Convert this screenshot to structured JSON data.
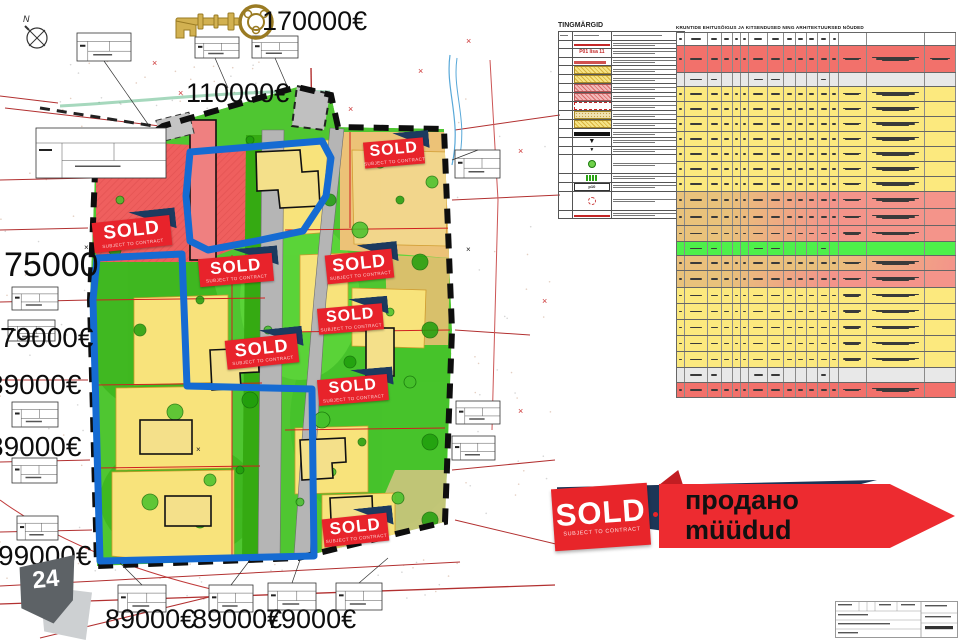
{
  "prices": [
    {
      "text": "170000€",
      "x": 262,
      "y": 6,
      "size": 27
    },
    {
      "text": "110000€",
      "x": 186,
      "y": 78,
      "size": 27
    },
    {
      "text": "75000",
      "x": 4,
      "y": 246,
      "size": 34
    },
    {
      "text": "79000€",
      "x": 0,
      "y": 322,
      "size": 28
    },
    {
      "text": "89000€",
      "x": -12,
      "y": 369,
      "size": 28
    },
    {
      "text": "89000€",
      "x": -12,
      "y": 431,
      "size": 28
    },
    {
      "text": "99000€",
      "x": -2,
      "y": 540,
      "size": 28
    },
    {
      "text": "89000€",
      "x": 105,
      "y": 604,
      "size": 27
    },
    {
      "text": "89000€",
      "x": 192,
      "y": 604,
      "size": 27
    },
    {
      "text": "79000€",
      "x": 266,
      "y": 604,
      "size": 27
    }
  ],
  "sold_stamps": {
    "label": "SOLD",
    "sublabel": "SUBJECT TO CONTRACT",
    "items": [
      {
        "x": 364,
        "y": 140,
        "w": 60,
        "h": 26,
        "rot": -5
      },
      {
        "x": 93,
        "y": 219,
        "w": 78,
        "h": 30,
        "rot": -6
      },
      {
        "x": 199,
        "y": 256,
        "w": 74,
        "h": 28,
        "rot": -5
      },
      {
        "x": 326,
        "y": 252,
        "w": 67,
        "h": 29,
        "rot": -6
      },
      {
        "x": 318,
        "y": 306,
        "w": 65,
        "h": 26,
        "rot": -5
      },
      {
        "x": 226,
        "y": 337,
        "w": 72,
        "h": 29,
        "rot": -6
      },
      {
        "x": 318,
        "y": 377,
        "w": 70,
        "h": 26,
        "rot": -5
      },
      {
        "x": 323,
        "y": 516,
        "w": 65,
        "h": 28,
        "rot": -6
      }
    ]
  },
  "banner": {
    "sold": "SOLD",
    "sub": "SUBJECT TO CONTRACT",
    "line1": "продано",
    "line2": "müüdud"
  },
  "badge": {
    "number": "24"
  },
  "compass": {
    "label": "N"
  },
  "legend": {
    "title": "TINGMÄRGID",
    "rows": [
      {
        "symbol": "redline",
        "text": ""
      },
      {
        "symbol": "redtext",
        "text": "P01 lisa 11"
      },
      {
        "symbol": "redbar",
        "text": ""
      },
      {
        "symbol": "yhatch",
        "text": ""
      },
      {
        "symbol": "yhatch",
        "text": ""
      },
      {
        "symbol": "phatch",
        "text": ""
      },
      {
        "symbol": "phatch",
        "text": ""
      },
      {
        "symbol": "reddash",
        "text": ""
      },
      {
        "symbol": "ydots",
        "text": ""
      },
      {
        "symbol": "yhatch",
        "text": ""
      },
      {
        "symbol": "blackbar",
        "text": ""
      },
      {
        "symbol": "tri",
        "text": ""
      },
      {
        "symbol": "smalltri",
        "text": ""
      },
      {
        "symbol": "greencircle",
        "text": ""
      },
      {
        "symbol": "greenbars",
        "text": ""
      },
      {
        "symbol": "pbox",
        "text": "p10"
      },
      {
        "symbol": "dashcircle",
        "text": ""
      },
      {
        "symbol": "redline",
        "text": ""
      }
    ]
  },
  "table": {
    "title": "KRUNTIDE EHITUSÕIGUS JA KITSENDUSED NING ARHITEKTUURSED NÕUDED",
    "col_widths": [
      3,
      8,
      5,
      4,
      3,
      3,
      6.5,
      6,
      4,
      4,
      4,
      4.5,
      3,
      10,
      21,
      11
    ],
    "rows": [
      {
        "h": 13,
        "color": "white"
      },
      {
        "h": 27,
        "color": "red"
      },
      {
        "h": 14,
        "color": "gray"
      },
      {
        "h": 15,
        "color": "yellow"
      },
      {
        "h": 15,
        "color": "yellow"
      },
      {
        "h": 15,
        "color": "yellow"
      },
      {
        "h": 15,
        "color": "yellow"
      },
      {
        "h": 15,
        "color": "yellow"
      },
      {
        "h": 15,
        "color": "yellow"
      },
      {
        "h": 15,
        "color": "yellow"
      },
      {
        "h": 17,
        "color": "salmon"
      },
      {
        "h": 17,
        "color": "salmon"
      },
      {
        "h": 16,
        "color": "salmon"
      },
      {
        "h": 14,
        "color": "green"
      },
      {
        "h": 15,
        "color": "tan"
      },
      {
        "h": 17,
        "color": "salmon"
      },
      {
        "h": 16,
        "color": "yellow"
      },
      {
        "h": 16,
        "color": "yellow"
      },
      {
        "h": 16,
        "color": "yellow"
      },
      {
        "h": 16,
        "color": "yellow"
      },
      {
        "h": 16,
        "color": "yellow"
      },
      {
        "h": 15,
        "color": "gray"
      },
      {
        "h": 16,
        "color": "red"
      }
    ]
  },
  "map": {
    "boxes": [
      {
        "x": 77,
        "y": 33,
        "w": 54,
        "h": 28
      },
      {
        "x": 195,
        "y": 37,
        "w": 44,
        "h": 21
      },
      {
        "x": 252,
        "y": 36,
        "w": 46,
        "h": 22
      },
      {
        "x": 36,
        "y": 128,
        "w": 130,
        "h": 50
      },
      {
        "x": 12,
        "y": 287,
        "w": 46,
        "h": 23
      },
      {
        "x": 8,
        "y": 320,
        "w": 47,
        "h": 21
      },
      {
        "x": 12,
        "y": 402,
        "w": 46,
        "h": 25
      },
      {
        "x": 12,
        "y": 458,
        "w": 45,
        "h": 25
      },
      {
        "x": 17,
        "y": 516,
        "w": 41,
        "h": 24
      },
      {
        "x": 455,
        "y": 150,
        "w": 45,
        "h": 28
      },
      {
        "x": 456,
        "y": 401,
        "w": 44,
        "h": 23
      },
      {
        "x": 452,
        "y": 436,
        "w": 43,
        "h": 24
      },
      {
        "x": 118,
        "y": 585,
        "w": 48,
        "h": 27
      },
      {
        "x": 209,
        "y": 585,
        "w": 44,
        "h": 27
      },
      {
        "x": 268,
        "y": 583,
        "w": 48,
        "h": 27
      },
      {
        "x": 336,
        "y": 583,
        "w": 46,
        "h": 27
      }
    ],
    "trees": [
      [
        120,
        200
      ],
      [
        140,
        330
      ],
      [
        160,
        430
      ],
      [
        200,
        300
      ],
      [
        210,
        480
      ],
      [
        250,
        400
      ],
      [
        268,
        330
      ],
      [
        330,
        200
      ],
      [
        360,
        230
      ],
      [
        400,
        200
      ],
      [
        432,
        182
      ],
      [
        420,
        262
      ],
      [
        390,
        312
      ],
      [
        350,
        362
      ],
      [
        322,
        420
      ],
      [
        362,
        442
      ],
      [
        410,
        382
      ],
      [
        430,
        442
      ],
      [
        300,
        502
      ],
      [
        200,
        522
      ],
      [
        150,
        502
      ],
      [
        250,
        140
      ],
      [
        380,
        162
      ],
      [
        430,
        330
      ],
      [
        332,
        472
      ],
      [
        115,
        250
      ],
      [
        175,
        412
      ],
      [
        240,
        470
      ],
      [
        398,
        498
      ],
      [
        430,
        520
      ]
    ]
  },
  "colors": {
    "stamp_red": "#e8232b",
    "navy": "#1c3a5f",
    "blue_outline": "#156bd2",
    "map_green": "#4fc631",
    "plot_yellow": "#f8e37b",
    "zone_red": "#ef5f5e",
    "zone_tan": "#ecc277",
    "road_gray": "#b5b5b5",
    "key_gold": "#c5a348"
  }
}
